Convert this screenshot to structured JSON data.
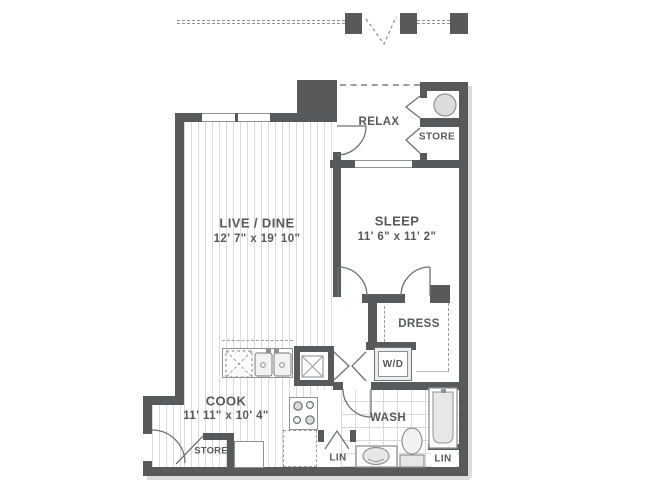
{
  "floorplan": {
    "title": "One-bedroom apartment floor plan",
    "rooms": [
      {
        "id": "live_dine",
        "label": "LIVE / DINE",
        "dims": "12' 7\" x 19' 10\""
      },
      {
        "id": "sleep",
        "label": "SLEEP",
        "dims": "11' 6\" x 11' 2\""
      },
      {
        "id": "cook",
        "label": "COOK",
        "dims": "11' 11\" x 10' 4\""
      },
      {
        "id": "relax",
        "label": "RELAX"
      },
      {
        "id": "store_upper",
        "label": "STORE"
      },
      {
        "id": "dress",
        "label": "DRESS"
      },
      {
        "id": "wd_closet",
        "label": "W/D"
      },
      {
        "id": "wash",
        "label": "WASH"
      },
      {
        "id": "lin_hall",
        "label": "LIN"
      },
      {
        "id": "lin_bath",
        "label": "LIN"
      },
      {
        "id": "store_entry",
        "label": "STORE"
      }
    ],
    "colors": {
      "wall": "#58595b",
      "text": "#58595b",
      "floor_line": "#dadada",
      "tile_line": "#d9d9d9",
      "fixture_stroke": "#8f9193",
      "fixture_fill": "#e7e7e7",
      "shadow": "#dcdcdc"
    }
  }
}
